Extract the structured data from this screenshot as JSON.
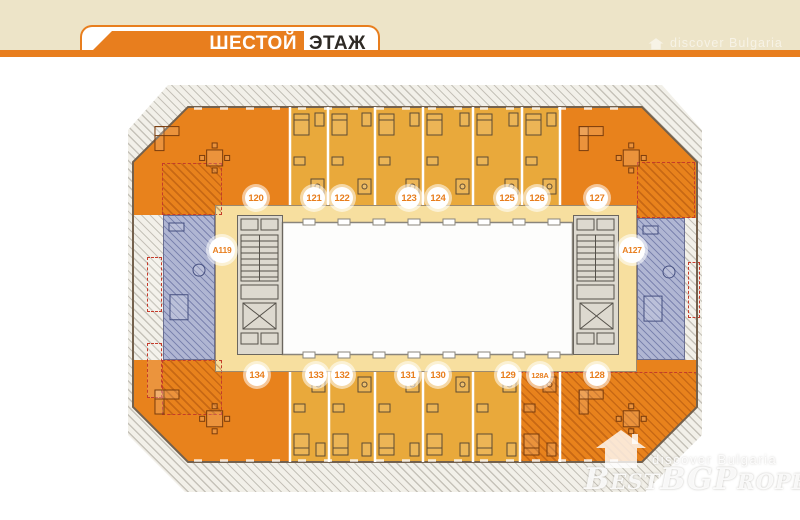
{
  "header": {
    "floor_title_primary": "ШЕСТОЙ",
    "floor_title_secondary": "ЭТАЖ"
  },
  "watermarks": {
    "top_tagline": "discover Bulgaria",
    "bottom_tagline": "discover Bulgaria",
    "brand": "BestBGProperties"
  },
  "colors": {
    "brand": "#E87E1E",
    "orange_unit": "#E8821C",
    "amber_unit": "#E9A93B",
    "corridor": "#F7DF9F",
    "blue_unit": "#B0B6D3",
    "core": "#DDD9CF",
    "beige": "#EDE4C8",
    "ink": "#2E2A25",
    "red_dash": "#C53B2B",
    "badge_text": "#E87E1E"
  },
  "floor_plan": {
    "units": [
      {
        "label": "120",
        "type": "corner-orange",
        "badge": {
          "x": 128,
          "y": 113
        },
        "area": {
          "x": 5,
          "y": 22,
          "w": 157,
          "h": 98
        }
      },
      {
        "label": "121",
        "type": "studio-amber",
        "badge": {
          "x": 186,
          "y": 113
        },
        "area": {
          "x": 162,
          "y": 22,
          "w": 38,
          "h": 98
        }
      },
      {
        "label": "122",
        "type": "studio-amber",
        "badge": {
          "x": 214,
          "y": 113
        },
        "area": {
          "x": 200,
          "y": 22,
          "w": 47,
          "h": 98
        }
      },
      {
        "label": "123",
        "type": "studio-amber",
        "badge": {
          "x": 281,
          "y": 113
        },
        "area": {
          "x": 247,
          "y": 22,
          "w": 48,
          "h": 98
        }
      },
      {
        "label": "124",
        "type": "studio-amber",
        "badge": {
          "x": 310,
          "y": 113
        },
        "area": {
          "x": 295,
          "y": 22,
          "w": 50,
          "h": 98
        }
      },
      {
        "label": "125",
        "type": "studio-amber",
        "badge": {
          "x": 379,
          "y": 113
        },
        "area": {
          "x": 345,
          "y": 22,
          "w": 49,
          "h": 98
        }
      },
      {
        "label": "126",
        "type": "studio-amber",
        "badge": {
          "x": 409,
          "y": 113
        },
        "area": {
          "x": 394,
          "y": 22,
          "w": 38,
          "h": 98
        }
      },
      {
        "label": "127",
        "type": "corner-orange",
        "badge": {
          "x": 469,
          "y": 113
        },
        "area": {
          "x": 432,
          "y": 22,
          "w": 137,
          "h": 98
        }
      },
      {
        "label": "A119",
        "type": "apartment-blue",
        "badge": {
          "x": 94,
          "y": 165
        },
        "area": {
          "x": 35,
          "y": 130,
          "w": 52,
          "h": 145
        }
      },
      {
        "label": "A127",
        "type": "apartment-blue",
        "badge": {
          "x": 504,
          "y": 165
        },
        "area": {
          "x": 509,
          "y": 133,
          "w": 48,
          "h": 142
        }
      },
      {
        "label": "134",
        "type": "corner-orange",
        "badge": {
          "x": 129,
          "y": 290
        },
        "area": {
          "x": 5,
          "y": 287,
          "w": 157,
          "h": 90
        }
      },
      {
        "label": "133",
        "type": "studio-amber",
        "badge": {
          "x": 188,
          "y": 290
        },
        "area": {
          "x": 162,
          "y": 287,
          "w": 39,
          "h": 90
        }
      },
      {
        "label": "132",
        "type": "studio-amber",
        "badge": {
          "x": 214,
          "y": 290
        },
        "area": {
          "x": 201,
          "y": 287,
          "w": 46,
          "h": 90
        }
      },
      {
        "label": "131",
        "type": "studio-amber",
        "badge": {
          "x": 280,
          "y": 290
        },
        "area": {
          "x": 247,
          "y": 287,
          "w": 48,
          "h": 90
        }
      },
      {
        "label": "130",
        "type": "studio-amber",
        "badge": {
          "x": 310,
          "y": 290
        },
        "area": {
          "x": 295,
          "y": 287,
          "w": 50,
          "h": 90
        }
      },
      {
        "label": "129",
        "type": "studio-amber",
        "badge": {
          "x": 380,
          "y": 290
        },
        "area": {
          "x": 345,
          "y": 287,
          "w": 47,
          "h": 90
        }
      },
      {
        "label": "128A",
        "type": "studio-orange-hatched",
        "badge": {
          "x": 412,
          "y": 290
        },
        "area": {
          "x": 392,
          "y": 287,
          "w": 40,
          "h": 90
        }
      },
      {
        "label": "128",
        "type": "corner-orange-hatched",
        "badge": {
          "x": 469,
          "y": 290
        },
        "area": {
          "x": 432,
          "y": 287,
          "w": 137,
          "h": 90
        }
      }
    ]
  }
}
